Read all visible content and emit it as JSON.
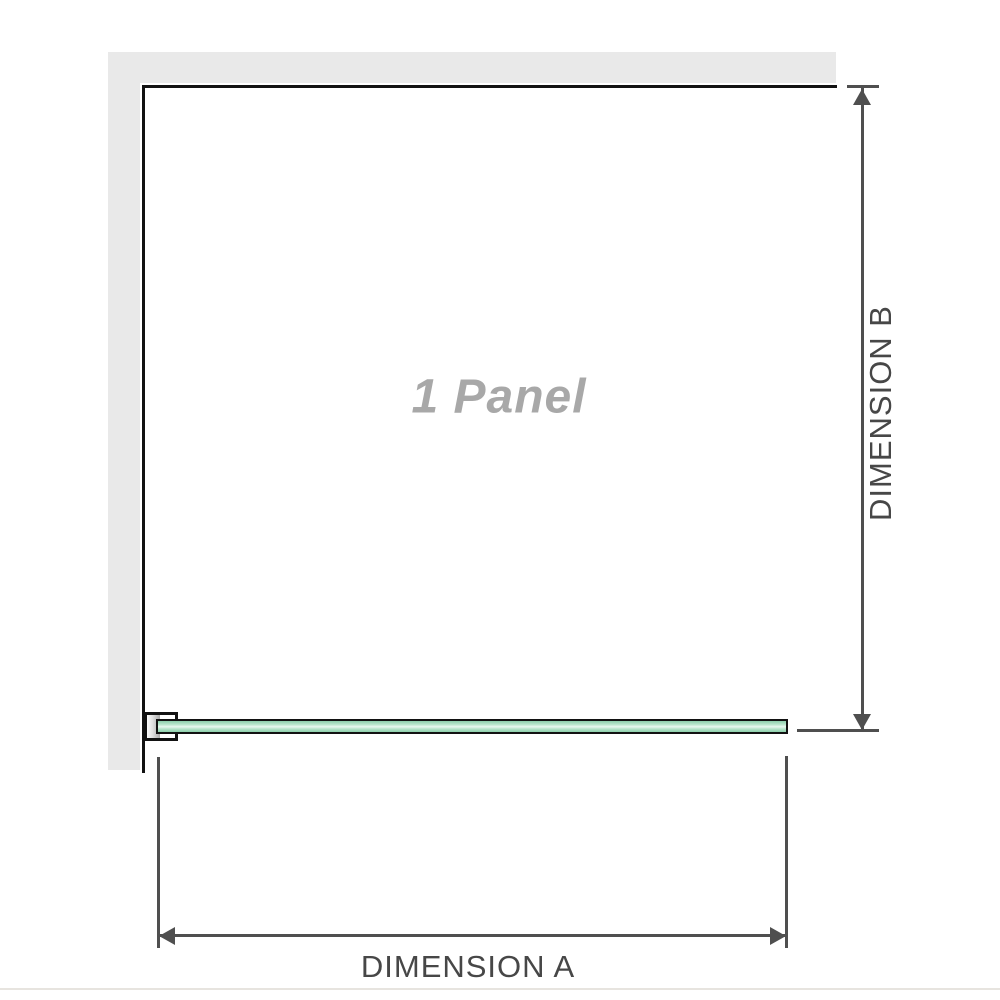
{
  "diagram": {
    "panel_label": "1 Panel",
    "dimension_a_label": "DIMENSION A",
    "dimension_b_label": "DIMENSION B"
  },
  "colors": {
    "wall_fill": "#e9e9e9",
    "wall_edge": "#121212",
    "bracket_metal": "#a9a9a9",
    "glass_border": "#121212",
    "glass_green": "#b7e5cb",
    "glass_green_light": "#e9f9f0",
    "glass_green_dark": "#8ccfab",
    "dimension_line": "#4f4f4f",
    "label_text": "#474747",
    "panel_label_text": "#a8a8a8",
    "footer_line": "#e7e4df"
  }
}
